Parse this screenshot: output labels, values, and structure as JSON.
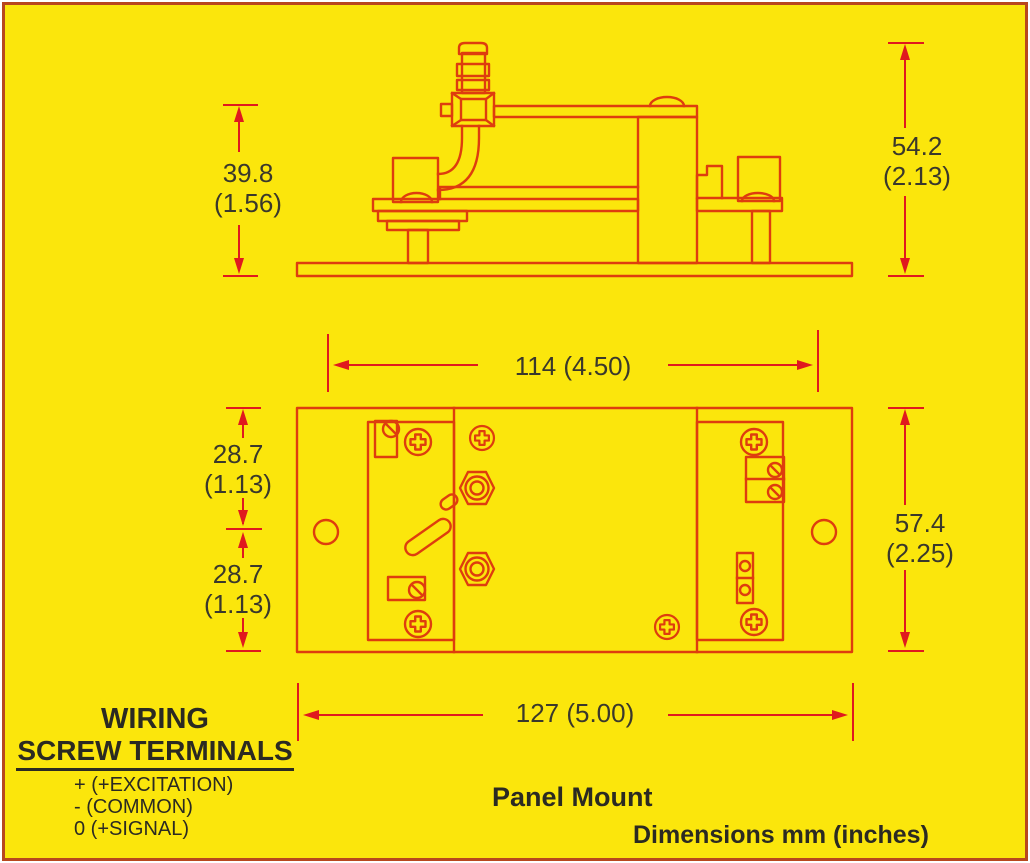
{
  "diagram": {
    "view_label": "Panel Mount",
    "units_note": "Dimensions mm (inches)"
  },
  "dimensions": {
    "terminal_height": {
      "mm": "39.8",
      "inches": "(1.56)"
    },
    "overall_height_side": {
      "mm": "54.2",
      "inches": "(2.13)"
    },
    "body_width": "114 (4.50)",
    "hole_to_top": {
      "mm": "28.7",
      "inches": "(1.13)"
    },
    "hole_to_bottom": {
      "mm": "28.7",
      "inches": "(1.13)"
    },
    "overall_height_top": {
      "mm": "57.4",
      "inches": "(2.25)"
    },
    "overall_width": "127 (5.00)"
  },
  "wiring": {
    "title_line1": "WIRING",
    "title_line2": "SCREW TERMINALS",
    "terminals": [
      "+ (+EXCITATION)",
      "- (COMMON)",
      "0 (+SIGNAL)"
    ]
  },
  "colors": {
    "background": "#FBE60C",
    "drawing_line": "#DE3D0E",
    "dimension_line": "#E0191E",
    "text": "#2B2A22",
    "border": "#B8471E"
  }
}
